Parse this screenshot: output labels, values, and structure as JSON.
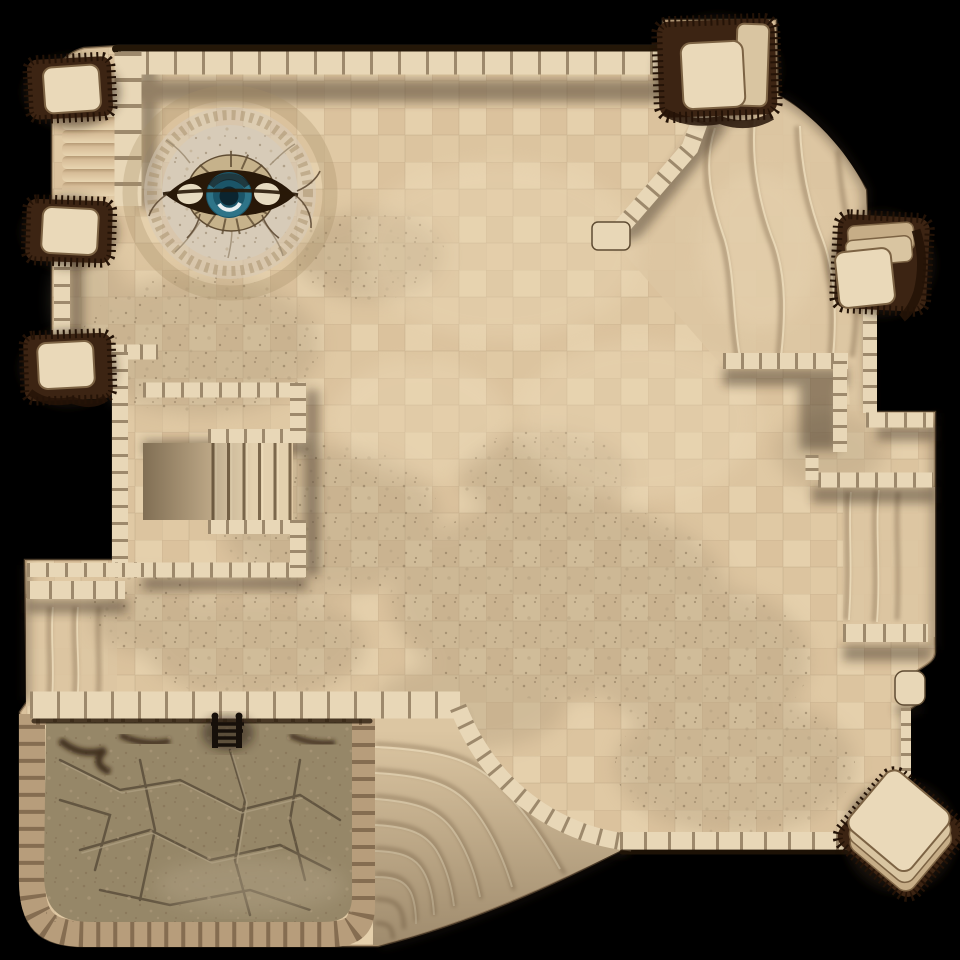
{
  "map": {
    "kind": "top-down desert temple battle map",
    "background": "black void outside walls",
    "visible_text": "none"
  },
  "palette": {
    "bg": "#000000",
    "floor_base": "#e0c9a4",
    "floor_tile_alt": "#d6bc95",
    "floor_tile_light": "#ecd9b7",
    "floor_seam": "#7a6446",
    "mottle_dark": "#b39f7f",
    "mottle_speck": "#7f6b50",
    "sand_smooth": "#dcc6a2",
    "groove_dark": "#8a7356",
    "groove_light": "#f0e0bf",
    "wall_light": "#e8d7b7",
    "wall_seam": "#7e684b",
    "wall_edge": "#5f4c33",
    "wall_rim": "#241708",
    "ledge_light": "#e3d0ae",
    "shadow": "#2f2313",
    "pit_rock": "#968768",
    "pit_crack": "#574a38",
    "pit_vein": "#b2a386",
    "pit_rim": "#b79d7b",
    "pit_rim_gap": "#533d28",
    "pit_fringe": "#2e1f10",
    "pillar_dark": "#3c2413",
    "pillar_darker": "#241307",
    "pillar_cap": "#ead9b9",
    "pillar_cap_mid": "#d9c5a1",
    "pillar_cap_deep": "#c6ad87",
    "pillar_cap_edge": "#7c6344",
    "stone_ring": "#c6b28b",
    "stone_inner": "#cdbb97",
    "dais_ring": "#a58d68",
    "dais_disc": "#d7cbb8",
    "iris_ring": "#2e7488",
    "iris_mid": "#1b5568",
    "pupil": "#0b2530",
    "eye_lid": "#281808",
    "sclera": "#e7dbc0",
    "ladder": "#17100a"
  },
  "features": {
    "eye_dais": {
      "center_x": 230,
      "center_y": 193,
      "halo_radius": 100,
      "disc_radius": 68,
      "iris_radius": 23
    },
    "northwest_stairs": {
      "treads": 7,
      "location": "left edge between first two pillars"
    },
    "inner_stair_alcove": {
      "treads": 5,
      "location": "left-center E-shaped wall block"
    },
    "curved_stairs": {
      "steps": 8,
      "location": "bottom center, fanning from pit wall to south wall"
    },
    "sand_slope_ne": {
      "contour_lines": 4
    },
    "sand_alcove_east": {
      "contour_lines": 3
    },
    "west_ramp": {
      "contour_lines": 3
    },
    "pit": {
      "location": "bottom left",
      "ladder_rungs": 4
    },
    "pillars": [
      "northwest",
      "west-upper",
      "west-lower",
      "northeast-large",
      "east",
      "southeast-rotated"
    ]
  }
}
